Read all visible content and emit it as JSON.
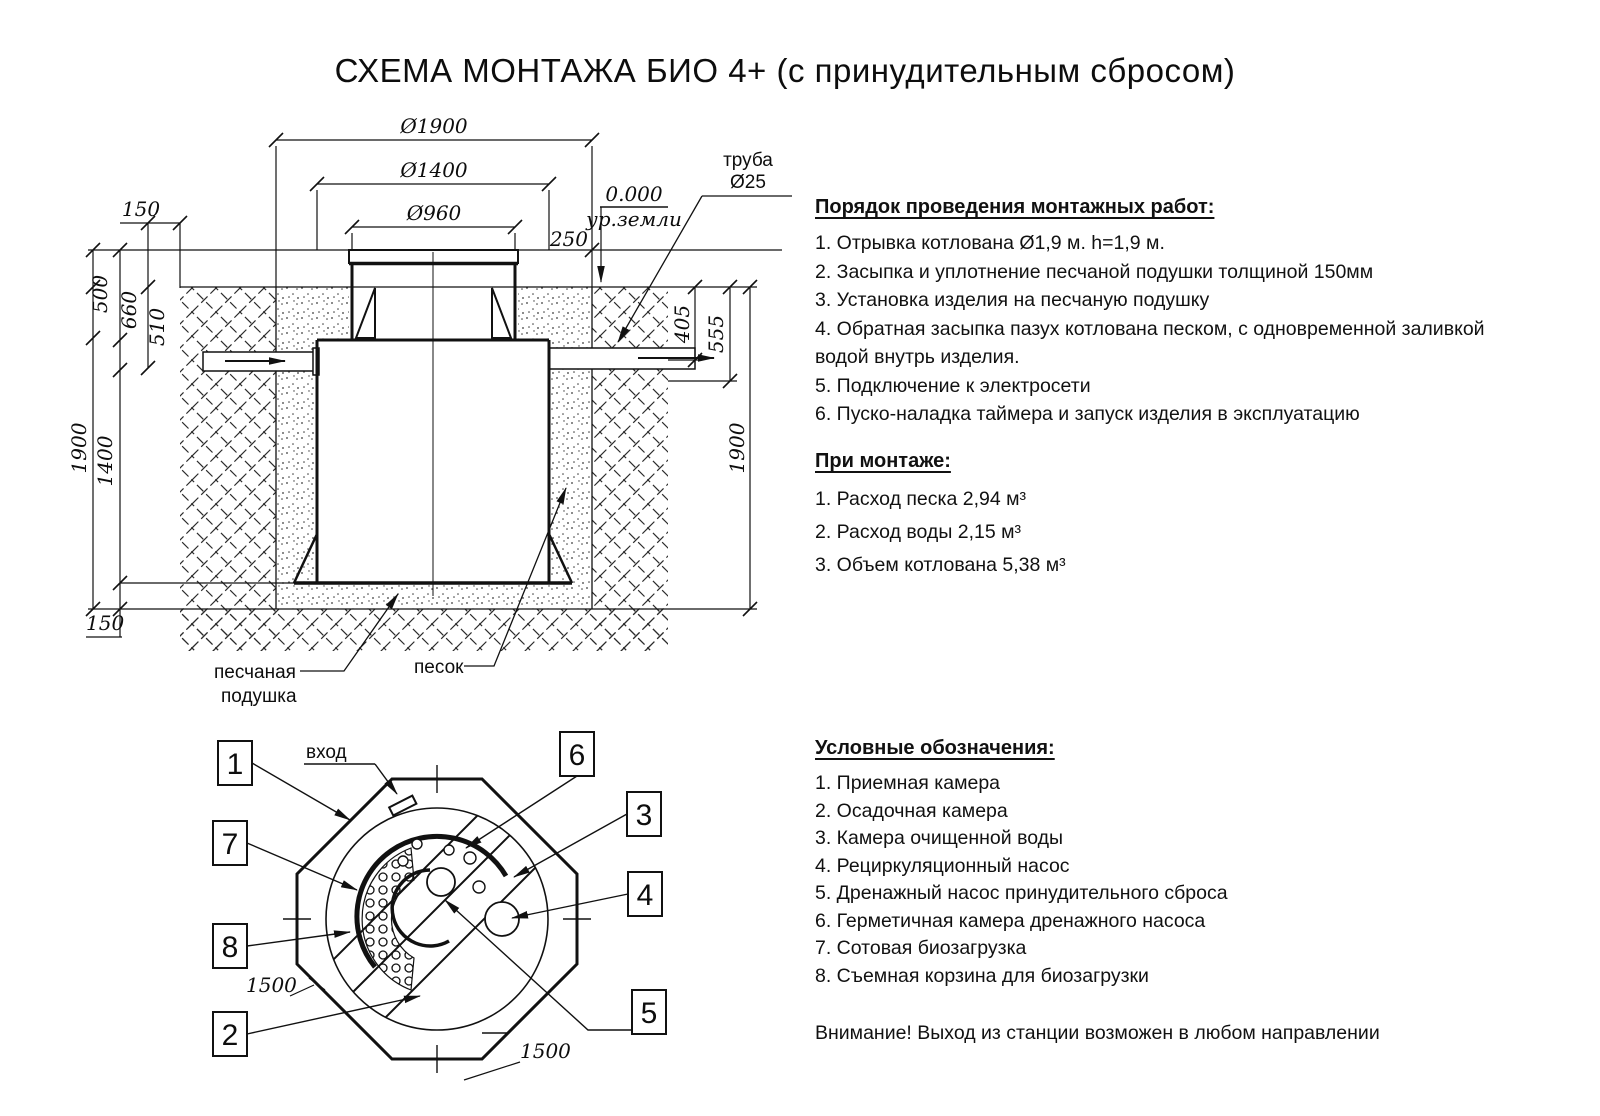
{
  "title": "СХЕМА МОНТАЖА БИО 4+ (с принудительным сбросом)",
  "cross_section": {
    "dim_d1900": "Ø1900",
    "dim_d1400": "Ø1400",
    "dim_d960": "Ø960",
    "dim_150_top": "150",
    "dim_500": "500",
    "dim_660": "660",
    "dim_510": "510",
    "dim_1900_left": "1900",
    "dim_1400_left": "1400",
    "dim_150_bottom": "150",
    "dim_250": "250",
    "dim_405": "405",
    "dim_555": "555",
    "dim_1900_right": "1900",
    "level_zero": "0.000",
    "level_ground": "ур.земли",
    "pipe_label_line1": "труба",
    "pipe_label_line2": "Ø25",
    "label_sand_cushion_line1": "песчаная",
    "label_sand_cushion_line2": "подушка",
    "label_sand": "песок"
  },
  "top_view": {
    "label_inlet": "вход",
    "dim_1500_left": "1500",
    "dim_1500_bottom": "1500",
    "callouts": [
      "1",
      "2",
      "3",
      "4",
      "5",
      "6",
      "7",
      "8"
    ]
  },
  "procedure": {
    "heading": "Порядок проведения монтажных работ:",
    "items": [
      "1. Отрывка котлована Ø1,9 м. h=1,9 м.",
      "2. Засыпка и уплотнение песчаной подушки толщиной 150мм",
      "3. Установка изделия на песчаную подушку",
      "4. Обратная засыпка пазух котлована песком, с одновременной заливкой водой внутрь изделия.",
      "5. Подключение к электросети",
      "6. Пуско-наладка таймера и запуск изделия в эксплуатацию"
    ]
  },
  "installation": {
    "heading": "При монтаже:",
    "items": [
      "1. Расход песка 2,94 м³",
      "2. Расход воды 2,15 м³",
      "3. Объем котлована 5,38 м³"
    ]
  },
  "legend": {
    "heading": "Условные обозначения:",
    "items": [
      "1. Приемная камера",
      "2. Осадочная камера",
      "3. Камера очищенной воды",
      "4. Рециркуляционный насос",
      "5. Дренажный насос принудительного сброса",
      "6. Герметичная камера дренажного насоса",
      "7. Сотовая биозагрузка",
      "8. Съемная корзина для биозагрузки"
    ]
  },
  "warning": "Внимание! Выход из станции возможен в любом направлении"
}
